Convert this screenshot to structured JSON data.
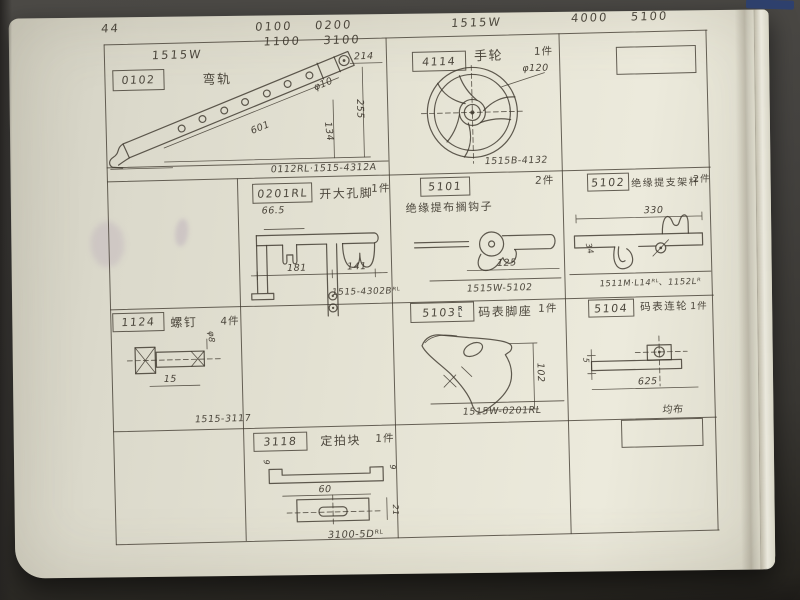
{
  "meta": {
    "page_number": "44"
  },
  "header": {
    "model_left": "1515W",
    "codes_top": "0100    0200",
    "codes_bottom": "1100    3100",
    "model_right": "1515W",
    "codes_right": "4000    5100"
  },
  "cells": {
    "c0102": {
      "part_no": "0102",
      "name": "弯轨",
      "dims": {
        "a": "214",
        "b": "601",
        "c": "255",
        "d": "134",
        "e": "φ10"
      },
      "note": "0112RL·1515-4312A"
    },
    "c4114": {
      "part_no": "4114",
      "name": "手轮",
      "qty": "1件",
      "dims": {
        "a": "φ120"
      },
      "note": "1515B-4132"
    },
    "c0201": {
      "part_no": "0201RL",
      "name": "开大孔脚",
      "qty": "1件",
      "dims": {
        "a": "66.5",
        "b": "181",
        "c": "141"
      },
      "note": "1515-4302Bᴿᴸ"
    },
    "c5101": {
      "part_no": "5101",
      "name": "绝缘提布搁钩子",
      "qty": "2件",
      "dims": {
        "a": "125"
      },
      "note": "1515W-5102"
    },
    "c5102": {
      "part_no": "5102",
      "name": "绝缘提支架杆",
      "qty": "2件",
      "dims": {
        "a": "330",
        "b": "34"
      },
      "note": "1511M·L14ᴿᴸ、1152Lᴿ"
    },
    "c1124": {
      "part_no": "1124",
      "name": "螺钉",
      "qty": "4件",
      "dims": {
        "a": "15",
        "b": "φ8"
      },
      "note": "1515-3117"
    },
    "c5103": {
      "part_no": "5103",
      "suffix_top": "R",
      "suffix_bottom": "L",
      "name": "码表脚座",
      "qty": "1件",
      "dims": {
        "a": "102"
      },
      "note": "1515W-0201RL"
    },
    "c5104": {
      "part_no": "5104",
      "name": "码表连轮",
      "qty": "1件",
      "dims": {
        "a": "625",
        "b": "5"
      },
      "note": "均布"
    },
    "c3118": {
      "part_no": "3118",
      "name": "定拍块",
      "qty": "1件",
      "dims": {
        "a": "60",
        "b": "9",
        "c": "21"
      },
      "note": "3100-5Dᴿᴸ"
    }
  }
}
